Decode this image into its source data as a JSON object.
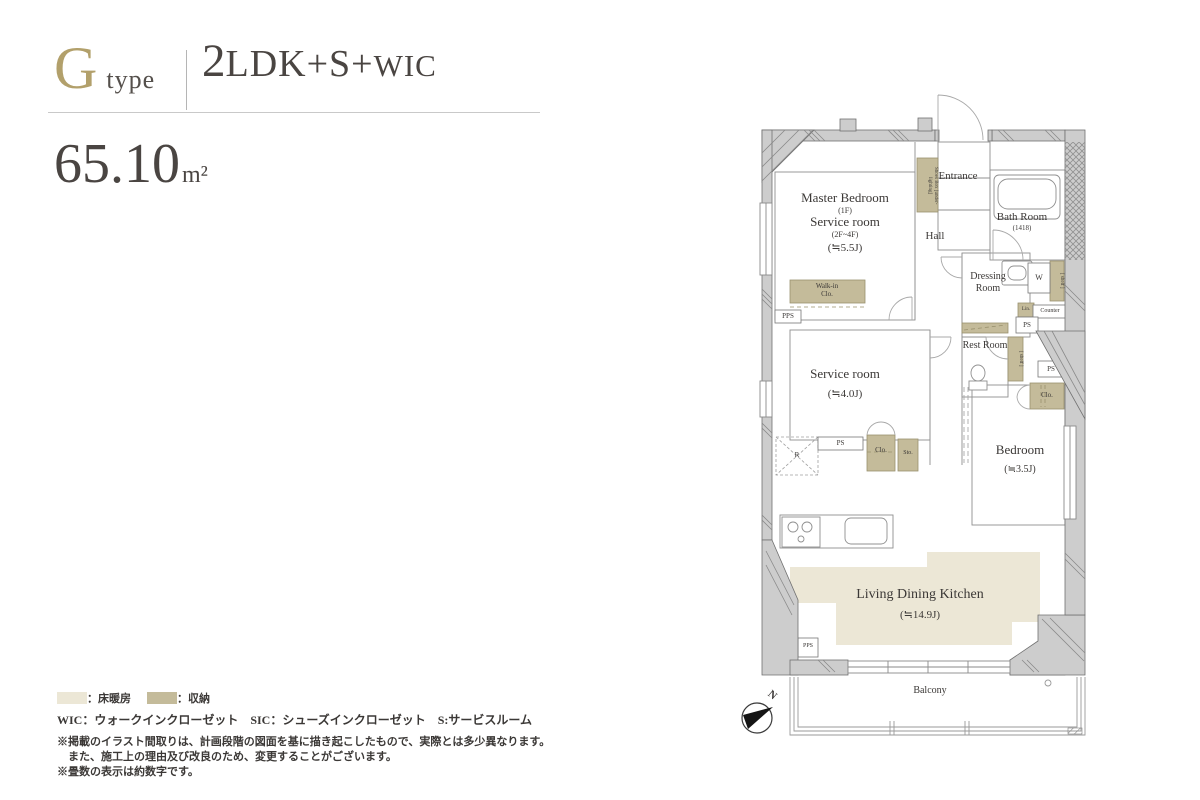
{
  "header": {
    "type_letter": "G",
    "type_word": "type",
    "plan_num": "2",
    "plan_mid": "LDK+S+",
    "plan_tail": "WIC",
    "area_value": "65.10",
    "area_unit": "m²"
  },
  "plan": {
    "master_bedroom": {
      "name": "Master Bedroom",
      "floor1": "(1F)",
      "alt_name": "Service room",
      "floor2": "(2F~4F)",
      "size": "(≒5.5J)"
    },
    "shoes_box": "Shoes Box [under-lighting]",
    "entrance": "Entrance",
    "hall": "Hall",
    "bath_room": {
      "name": "Bath Room",
      "size": "(1418)"
    },
    "dressing_room": "Dressing Room",
    "washer": "W",
    "shelf": "[ shelf ]",
    "linen": "Lin.",
    "counter": "Counter",
    "rest_room": "Rest Room",
    "bedroom": {
      "name": "Bedroom",
      "size": "(≒3.5J)"
    },
    "service_room": {
      "name": "Service room",
      "size": "(≒4.0J)"
    },
    "walk_in_closet": "Walk-in Clo.",
    "ldk": {
      "name": "Living Dining Kitchen",
      "size": "(≒14.9J)"
    },
    "balcony": "Balcony",
    "pps": "PPS",
    "ps": "PS",
    "clo": "Clo.",
    "sto": "Sto.",
    "refrigerator": "R",
    "north": "N"
  },
  "legend": {
    "floor_heating_label": "：床暖房",
    "storage_label": "：収納",
    "abbreviations": "WIC：ウォークインクローゼット　SIC：シューズインクローゼット　S:サービスルーム"
  },
  "notes": [
    "※掲載のイラスト間取りは、計画段階の図面を基に描き起こしたもので、実際とは多少異なります。",
    "また、施工上の理由及び改良のため、変更することがございます。",
    "※畳数の表示は約数字です。"
  ],
  "colors": {
    "accent_gold": "#b2a06b",
    "floor_heating": "#ece7d6",
    "storage": "#c4bb9a",
    "wall_gray": "#cdcdcd"
  }
}
